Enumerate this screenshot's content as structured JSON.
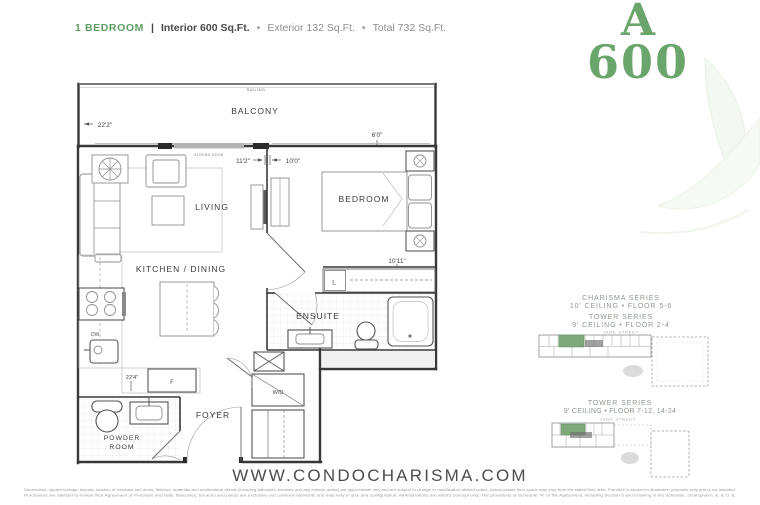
{
  "header": {
    "unit_type": "1 BEDROOM",
    "separator": "|",
    "interior": "Interior 600 Sq.Ft.",
    "bullet": "•",
    "exterior": "Exterior 132 Sq.Ft.",
    "total": "Total 732 Sq.Ft."
  },
  "unit_badge": {
    "letter": "A",
    "number": "600",
    "color": "#6aa66c"
  },
  "floorplan": {
    "rooms": {
      "balcony": "BALCONY",
      "living": "LIVING",
      "bedroom": "BEDROOM",
      "kitchen_dining": "KITCHEN / DINING",
      "ensuite": "ENSUITE",
      "foyer": "FOYER",
      "powder_line1": "POWDER",
      "powder_line2": "ROOM"
    },
    "labels": {
      "railing": "RAILING",
      "sliding_door": "SLIDING DOOR",
      "washer_dryer": "W/D",
      "fridge": "F",
      "dishwasher": "DW",
      "linen": "L"
    },
    "dimensions": {
      "balcony_width": "22'2\"",
      "balcony_depth": "6'0\"",
      "living_width": "11'2\"",
      "bedroom_width": "10'0\"",
      "bedroom_depth": "10'11\"",
      "kitchen_run": "22'4\""
    }
  },
  "keyplans": [
    {
      "title_line1": "CHARISMA SERIES",
      "title_line2": "10' CEILING • FLOOR 5-6",
      "title_line3": "TOWER SERIES",
      "title_line4": "9' CEILING • FLOOR 2-4",
      "street": "JANE STREET"
    },
    {
      "title_line1": "TOWER SERIES",
      "title_line2": "9' CEILING • FLOOR 7-12, 14-24",
      "street": "JANE STREET"
    }
  ],
  "footer": {
    "website": "WWW.CONDOCHARISMA.COM",
    "disclaimer_line1": "Dimensions, square footage, layouts, location of windows and doors, finishes, materials and architectural details (including balconies, terraces and any exterior areas) are approximate only and are subject to change or modification without notice. Actual usable floor space may vary from the stated floor area. Furniture is shown for illustration purposes only and is not included.",
    "disclaimer_line2": "Purchasers are advised to review their Agreement of Purchase and Sale. Balconies, terraces and patios are exclusive use common elements and may vary in size and configuration. All illustrations are artist's concept only. The provisions of Schedule \"A\" of the Agreement, including Section 5 and Drawing in the Schedule, shall govern. E. & O. E."
  }
}
